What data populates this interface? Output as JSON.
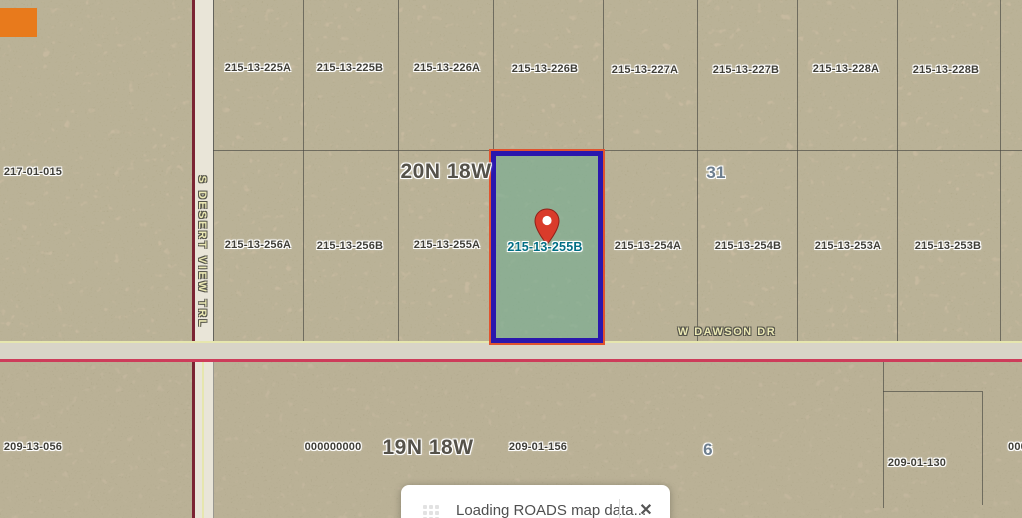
{
  "map_labels": {
    "township_upper": "20N 18W",
    "section_upper": "31",
    "township_lower": "19N 18W",
    "section_lower": "6"
  },
  "roads": {
    "vertical_road": "S DESERT VIEW TRL",
    "horizontal_road": "W DAWSON DR"
  },
  "parcels_row_top": [
    "215-13-225A",
    "215-13-225B",
    "215-13-226A",
    "215-13-226B",
    "215-13-227A",
    "215-13-227B",
    "215-13-228A",
    "215-13-228B"
  ],
  "parcels_row_mid": [
    "215-13-256A",
    "215-13-256B",
    "215-13-255A",
    "215-13-254A",
    "215-13-254B",
    "215-13-253A",
    "215-13-253B"
  ],
  "parcel_left": "217-01-015",
  "parcels_bottom": [
    "209-13-056",
    "000000000",
    "209-01-156",
    "209-01-130",
    "000"
  ],
  "selected_parcel": {
    "id": "215-13-255B",
    "fill_color": "#69ac90",
    "border_color": "#2a17ad",
    "outline_color": "#e0532f",
    "label_color": "#006e84",
    "pin_color": "#d93b2b"
  },
  "loading_dialog": {
    "message": "Loading ROADS map data...",
    "close": "✕"
  },
  "colors": {
    "terrain_upper": "#c8b89d",
    "terrain_lower": "#c2b299",
    "road_fill": "#e9e5d8",
    "road_edge_maroon": "#7b2433",
    "road_edge_pink": "#cd3c5a",
    "road_edge_yellow": "#e6e6ae"
  }
}
